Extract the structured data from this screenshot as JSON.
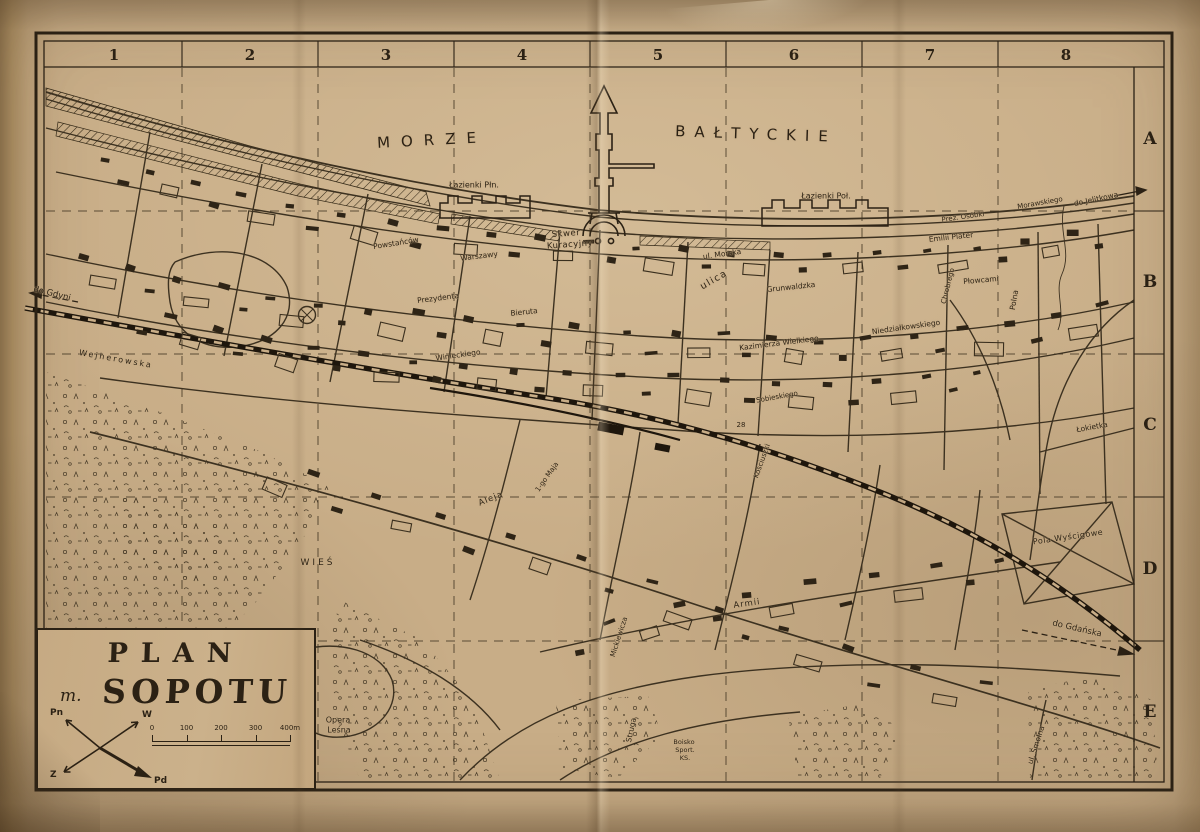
{
  "sea": {
    "word1": "MORZE",
    "word2": "BAŁTYCKIE"
  },
  "grid": {
    "columns": [
      "1",
      "2",
      "3",
      "4",
      "5",
      "6",
      "7",
      "8"
    ],
    "rows": [
      "A",
      "B",
      "C",
      "D",
      "E"
    ]
  },
  "title_box": {
    "line1": "PLAN",
    "prefix": "m.",
    "line2": "SOPOTU"
  },
  "compass": {
    "n": "Pn",
    "e": "W",
    "s": "Pd",
    "w": "Z"
  },
  "scale_bar": {
    "ticks": [
      "0",
      "100",
      "200",
      "300",
      "400m"
    ]
  },
  "labels": [
    {
      "t": "Łazienki Płn.",
      "x": 474,
      "y": 185,
      "r": 0,
      "s": 8,
      "ls": 0
    },
    {
      "t": "Łazienki Poł.",
      "x": 826,
      "y": 196,
      "r": 0,
      "s": 8,
      "ls": 0
    },
    {
      "t": "Skwer",
      "x": 566,
      "y": 234,
      "r": -4,
      "s": 8.5,
      "ls": 0.5
    },
    {
      "t": "Kuracyjny",
      "x": 570,
      "y": 245,
      "r": -4,
      "s": 8.5,
      "ls": 0.5
    },
    {
      "t": "do Gdyni",
      "x": 52,
      "y": 294,
      "r": 14,
      "s": 8.5,
      "ls": 0
    },
    {
      "t": "Wejherowska",
      "x": 116,
      "y": 359,
      "r": 10,
      "s": 8,
      "ls": 2
    },
    {
      "t": "Powstańców",
      "x": 396,
      "y": 243,
      "r": -9,
      "s": 7.5,
      "ls": 0
    },
    {
      "t": "Warszawy",
      "x": 479,
      "y": 256,
      "r": -7,
      "s": 7.5,
      "ls": 0
    },
    {
      "t": "Prezydenta",
      "x": 438,
      "y": 298,
      "r": -7,
      "s": 7.5,
      "ls": 0
    },
    {
      "t": "Bieruta",
      "x": 524,
      "y": 312,
      "r": -6,
      "s": 7.5,
      "ls": 0
    },
    {
      "t": "Winieckiego",
      "x": 458,
      "y": 355,
      "r": -8,
      "s": 7.5,
      "ls": 0
    },
    {
      "t": "ul. Morska",
      "x": 722,
      "y": 254,
      "r": -8,
      "s": 7.5,
      "ls": 0
    },
    {
      "t": "ulica",
      "x": 714,
      "y": 280,
      "r": -30,
      "s": 9.5,
      "ls": 1.5
    },
    {
      "t": "Grunwaldzka",
      "x": 791,
      "y": 287,
      "r": -6,
      "s": 7.5,
      "ls": 0
    },
    {
      "t": "Kazimierza Wielkiego",
      "x": 779,
      "y": 343,
      "r": -7,
      "s": 7.5,
      "ls": 0
    },
    {
      "t": "Niedziałkowskiego",
      "x": 906,
      "y": 327,
      "r": -8,
      "s": 7.5,
      "ls": 0
    },
    {
      "t": "Emilii Plater",
      "x": 951,
      "y": 237,
      "r": -6,
      "s": 7.5,
      "ls": 0
    },
    {
      "t": "Płowcami",
      "x": 981,
      "y": 280,
      "r": -5,
      "s": 7.5,
      "ls": 0
    },
    {
      "t": "Prez. Osóbki",
      "x": 963,
      "y": 217,
      "r": -8,
      "s": 7,
      "ls": 0
    },
    {
      "t": "Morawskiego",
      "x": 1040,
      "y": 203,
      "r": -10,
      "s": 7,
      "ls": 0
    },
    {
      "t": "do Jelitkowa",
      "x": 1096,
      "y": 199,
      "r": -12,
      "s": 7.5,
      "ls": 0
    },
    {
      "t": "Polna",
      "x": 1014,
      "y": 300,
      "r": -80,
      "s": 7.5,
      "ls": 0
    },
    {
      "t": "Chrobrego",
      "x": 948,
      "y": 286,
      "r": -76,
      "s": 7,
      "ls": 0
    },
    {
      "t": "Łokietka",
      "x": 1092,
      "y": 427,
      "r": -10,
      "s": 7.5,
      "ls": 0
    },
    {
      "t": "Pola Wyścigowe",
      "x": 1068,
      "y": 537,
      "r": -8,
      "s": 8,
      "ls": 0.5
    },
    {
      "t": "Sobieskiego",
      "x": 777,
      "y": 397,
      "r": -10,
      "s": 7,
      "ls": 0
    },
    {
      "t": "Kościuszki",
      "x": 762,
      "y": 461,
      "r": -70,
      "s": 7,
      "ls": 0
    },
    {
      "t": "Aleja",
      "x": 491,
      "y": 499,
      "r": -22,
      "s": 8.5,
      "ls": 1
    },
    {
      "t": "1-go Maja",
      "x": 547,
      "y": 477,
      "r": -55,
      "s": 7,
      "ls": 0
    },
    {
      "t": "Mickiewicza",
      "x": 619,
      "y": 637,
      "r": -72,
      "s": 7,
      "ls": 0
    },
    {
      "t": "Armii",
      "x": 747,
      "y": 604,
      "r": -8,
      "s": 8.5,
      "ls": 1
    },
    {
      "t": "Struga",
      "x": 631,
      "y": 730,
      "r": -78,
      "s": 7.5,
      "ls": 0
    },
    {
      "t": "WIEŚ",
      "x": 318,
      "y": 563,
      "r": 0,
      "s": 9,
      "ls": 3
    },
    {
      "t": "do Gdańska",
      "x": 1077,
      "y": 629,
      "r": 13,
      "s": 8.5,
      "ls": 0
    },
    {
      "t": "Opera",
      "x": 338,
      "y": 720,
      "r": 0,
      "s": 8,
      "ls": 0
    },
    {
      "t": "Leśna",
      "x": 339,
      "y": 730,
      "r": 0,
      "s": 8,
      "ls": 0
    },
    {
      "t": "ul. Smolna",
      "x": 1036,
      "y": 745,
      "r": -72,
      "s": 7.5,
      "ls": 0
    },
    {
      "t": "Boisko",
      "x": 684,
      "y": 742,
      "r": 0,
      "s": 6.5,
      "ls": 0
    },
    {
      "t": "Sport.",
      "x": 685,
      "y": 750,
      "r": 0,
      "s": 6.5,
      "ls": 0
    },
    {
      "t": "KS.",
      "x": 685,
      "y": 758,
      "r": 0,
      "s": 6.5,
      "ls": 0
    },
    {
      "t": "28",
      "x": 741,
      "y": 425,
      "r": 0,
      "s": 7,
      "ls": 0
    }
  ]
}
